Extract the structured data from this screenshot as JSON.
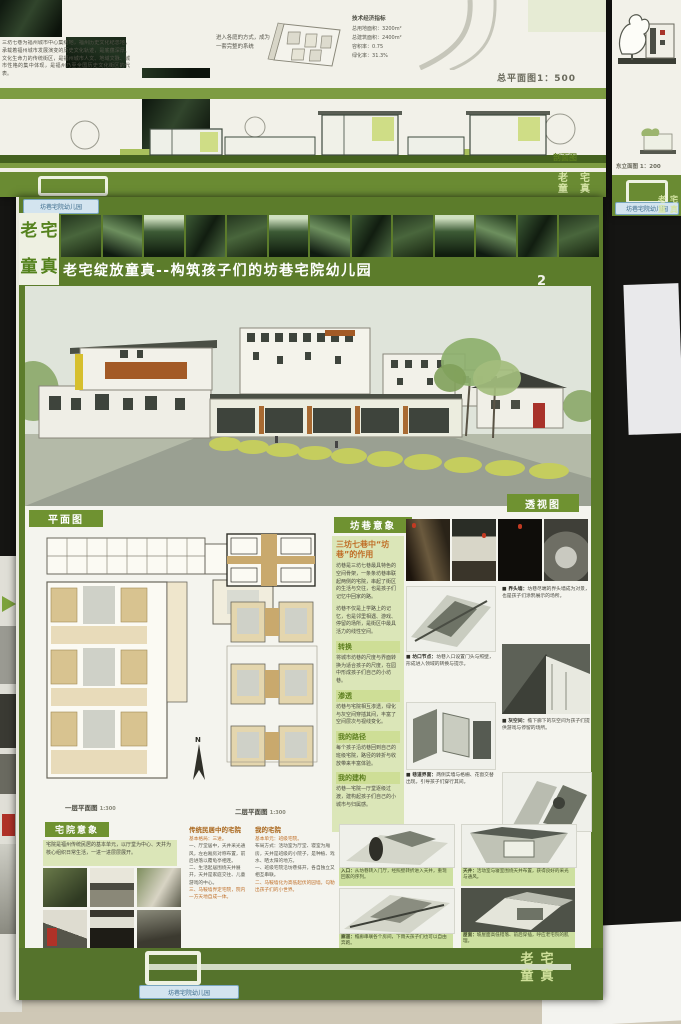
{
  "top_poster": {
    "intro_text": "三坊七巷为福州城市中心集结地，福州历史文化纪念地，承载着福州城市发展演变的历史文化轨迹，是底蕴深厚、文化生命力的传统街区，是福州城市人文、地域文脉、城市性格的集中体现，是福州乃至全国历史文化街区的代表。",
    "axon_caption": "进入各庭的方式，成为一套完整的系统",
    "indicators_title": "技术经济指标",
    "indicators": [
      {
        "label": "总用地面积：",
        "value": "3200m²"
      },
      {
        "label": "总建筑面积：",
        "value": "2400m²"
      },
      {
        "label": "容积率：",
        "value": "0.75"
      },
      {
        "label": "绿化率：",
        "value": "31.3%"
      }
    ],
    "site_plan_label": "总平面图1：500",
    "section_label": "剖面图",
    "tag_text": "坊巷宅院幼儿园"
  },
  "neighbor_poster": {
    "elevation_label": "东立面图 1：200",
    "tag_text": "坊巷宅院幼儿园",
    "mini_logo": "老宅童真"
  },
  "main_poster": {
    "tag_text": "坊巷宅院幼儿园",
    "logo": {
      "c1": "老",
      "c2": "宅",
      "c3": "童",
      "c4": "真"
    },
    "title": "老宅绽放童真--构筑孩子们的坊巷宅院幼儿园",
    "page_number": "2",
    "perspective_label": "透视图",
    "plans": {
      "label": "平面图",
      "caption1": "一层平面图",
      "scale1": "1:300",
      "caption2": "二层平面图",
      "scale2": "1:300",
      "north": "N"
    },
    "fangxiang": {
      "label": "坊巷意象",
      "subtitle": "三坊七巷中“坊巷”的作用",
      "p1": "坊巷是三坊七巷最具特色的空间骨架，一条条坊巷串联起两侧的宅院，串起了街区的生活与交往，也是孩子们记忆中回家的路。",
      "p2": "坊巷不仅是上学路上的记忆，也是邻里相遇、游戏、停留的场所，是街区中最具活力的线性空间。",
      "sections": [
        {
          "heading": "转换",
          "text": "将城市坊巷的尺度与界面转换为适合孩子的尺度，在园中形成孩子们自己的小坊巷。"
        },
        {
          "heading": "渗透",
          "text": "坊巷与宅院相互渗透，绿化与灰空间穿插其间，丰富了空间层次与视线变化。"
        },
        {
          "heading": "我的路径",
          "text": "每个孩子沿坊巷回到自己的班级宅院，路径的转折与收放带来丰富体验。"
        },
        {
          "heading": "我的建构",
          "text": "坊巷—宅院—厅堂逐级过渡，建构起孩子们自己的小城市与归属感。"
        }
      ],
      "notes": [
        {
          "title": "■ 坊口节点：",
          "text": "坊巷入口设置门头与照壁，形成进入领域的转换与提示。"
        },
        {
          "title": "■ 界头墙：",
          "text": "坊巷尽端的界头墙成为对景，也是孩子们涂鸦展示的场所。"
        },
        {
          "title": "■ 巷道界面：",
          "text": "两侧实墙与格栅、花窗交替出现，引导孩子们穿行其间。"
        },
        {
          "title": "■ 灰空间：",
          "text": "檐下廊下的灰空间为孩子们提供游戏与停留的场所。"
        }
      ]
    },
    "zhaiyuan": {
      "label": "宅院意象",
      "intro": "宅院是福州传统民居的基本单元，以厅堂为中心、天井为核心组织日常生活，一进一进层层展开。",
      "col1_title": "传统民居中的宅院",
      "col1_lines": [
        "基本格局：三进。",
        "一、厅堂居中，天井采光通风，左右厢房对称布置，前后进落以覆龟亭相连。",
        "二、生活起居围绕天井展开，天井是家庭交往、儿童游戏的中心。",
        "三、马鞍墙界定宅院，院内一方天地自成一体。"
      ],
      "col2_title": "我的宅院",
      "col2_lines": [
        "基本单元：班级宅院。",
        "布局方式：活动室为厅堂、寝室为厢房，天井是班级的小院子，是种植、戏水、晒太阳的地方。",
        "一、班级宅院沿坊巷排开，各自独立又相互串联。",
        "二、马鞍墙化为高低起伏的园墙，勾勒出孩子们的小世界。"
      ],
      "captions": [
        {
          "title": "入口：",
          "text": "从坊巷转入门厅，经照壁转折进入天井，重现回家的序列。"
        },
        {
          "title": "天井：",
          "text": "活动室与寝室围绕天井布置，获得良好的采光与通风。"
        },
        {
          "title": "廊道：",
          "text": "檐廊串联各个房间，下雨天孩子们也可以自由奔跑。"
        },
        {
          "title": "屋面：",
          "text": "坡屋面高低错落、前后穿插，呼应老宅院的肌理。"
        }
      ]
    },
    "footer_tag": "坊巷宅院幼儿园",
    "footer_logo": {
      "c1": "老",
      "c2": "宅",
      "c3": "童",
      "c4": "真"
    }
  }
}
